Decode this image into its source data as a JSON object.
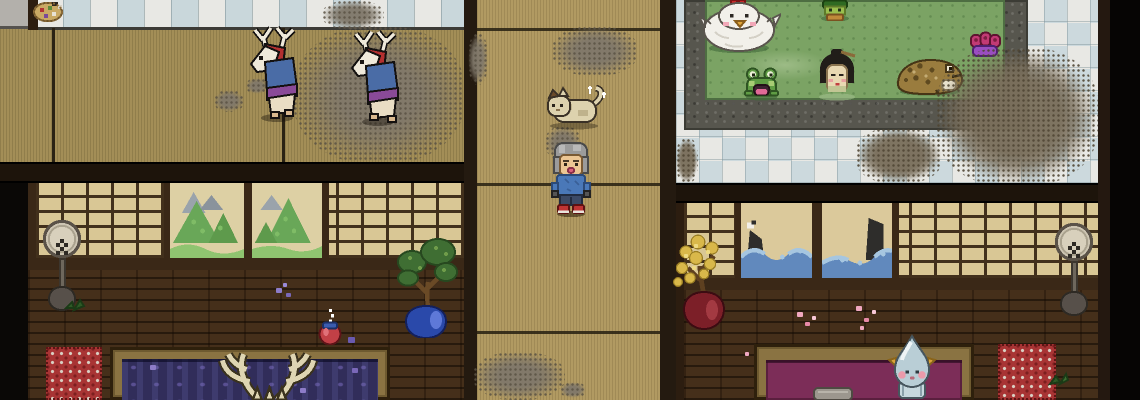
{
  "scene": {
    "type": "pixel-art top-down game scene",
    "setting": "Japanese bathhouse interior",
    "regions": {
      "tatami_hall": "tatami-mat hall with tiled ledge at top, two deer spirits walking, grime patches",
      "corridor": "vertical wooden-plank corridor with sleeping cat and player character",
      "communal_bath": "large green hot-spring pool with stone rim on checkered tile floor, heavily soiled tiles at right",
      "room_left": "private room: shoji screens with mountain paintings, brick wall, wooden tub of indigo water with submerged antlered spirit",
      "room_right": "private room: shoji screens with wave paintings, brick wall, wooden tub of magenta water with water-drop spirit"
    }
  },
  "entities": [
    {
      "id": "deer-spirit-1",
      "label": "deer spirit in blue robe walking left"
    },
    {
      "id": "deer-spirit-2",
      "label": "deer spirit in blue robe walking left"
    },
    {
      "id": "cat",
      "label": "cream fluffy cat resting with sparkles"
    },
    {
      "id": "player",
      "label": "gray-haired character in blue shirt facing down"
    },
    {
      "id": "chicken-spirit",
      "label": "large white hen with red comb soaking"
    },
    {
      "id": "kappa",
      "label": "green kappa at pool top edge"
    },
    {
      "id": "frog",
      "label": "small frog with open pink mouth"
    },
    {
      "id": "bathing-woman",
      "label": "black-haired woman soaking to her chin"
    },
    {
      "id": "toad",
      "label": "large brown warty toad"
    },
    {
      "id": "lotus",
      "label": "magenta lotus blossom on purple pad"
    },
    {
      "id": "basket",
      "label": "wicker basket of goods on tiled ledge"
    },
    {
      "id": "standing-fan-left",
      "label": "round standing fan"
    },
    {
      "id": "standing-fan-right",
      "label": "round standing fan"
    },
    {
      "id": "bonsai",
      "label": "bonsai tree in blue vase"
    },
    {
      "id": "golden-tree",
      "label": "golden-leaf tree in dark red vase"
    },
    {
      "id": "sake-jug",
      "label": "red jug with blue lid, drips above"
    },
    {
      "id": "antlered-spirit",
      "label": "antlers of spirit submerged in indigo tub"
    },
    {
      "id": "drop-spirit",
      "label": "pale-blue teardrop spirit with gold horns at tub edge"
    },
    {
      "id": "bucket",
      "label": "gray bucket in magenta tub"
    },
    {
      "id": "mountain-paintings",
      "label": "two shoji panels painted with green mountains"
    },
    {
      "id": "wave-paintings",
      "label": "two shoji panels painted with blue waves, rocks and a crane"
    },
    {
      "id": "red-mats",
      "label": "red patterned bath mats"
    },
    {
      "id": "petals",
      "label": "scattered pink and purple petals"
    }
  ],
  "palette": {
    "tatami": "#a38e57",
    "corridor_floor": "#b19a62",
    "tile_white": "#e8e8e4",
    "tile_blue": "#ccd9dd",
    "pool_green": "#7ba364",
    "stone_rim": "#57564e",
    "shoji_paper": "#d9c795",
    "wood_dark": "#42301c",
    "brick_wall": "#452f1a",
    "beam": "#1d140b",
    "tub_indigo": "#312d5a",
    "tub_magenta": "#7c2d58",
    "tub_frame": "#8a7342",
    "mat_red": "#a83434",
    "grime": "#7b7060",
    "robe_blue": "#4a6ca6",
    "sash_purple": "#8a4a98",
    "mane_red": "#b33030",
    "player_shirt": "#4a78b8",
    "drop_body": "#b9ced6"
  }
}
